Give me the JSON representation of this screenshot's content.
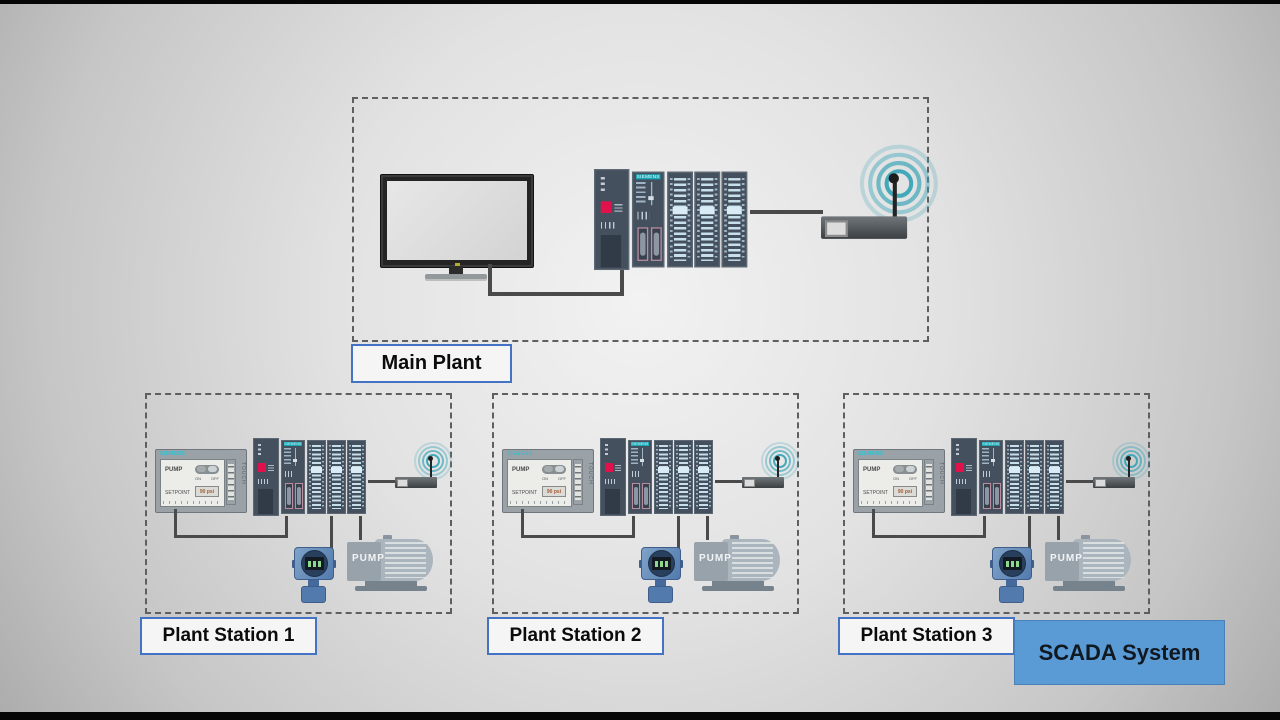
{
  "diagram": {
    "main_plant": {
      "label": "Main Plant"
    },
    "stations": [
      {
        "label": "Plant Station 1"
      },
      {
        "label": "Plant Station 2"
      },
      {
        "label": "Plant Station 3"
      }
    ],
    "scada": {
      "label": "SCADA System"
    }
  },
  "hmi": {
    "brand": "SIEMENS",
    "side_label": "TOUCH",
    "pump_row_label": "PUMP",
    "toggle_on": "ON",
    "toggle_off": "OFF",
    "setpoint_label": "SETPOINT",
    "setpoint_value": "90 psi"
  },
  "plc": {
    "brand": "SIEMENS"
  },
  "pump": {
    "label": "PUMP"
  },
  "icons": {
    "wifi": "wifi-signal-icon",
    "antenna": "router-antenna"
  },
  "colors": {
    "scada_fill": "#5B9BD5",
    "label_border": "#4472C4",
    "wifi_signal": "#3AA5B7",
    "plc_accent_red": "#E1114B",
    "siemens_teal": "#18A7B5"
  }
}
